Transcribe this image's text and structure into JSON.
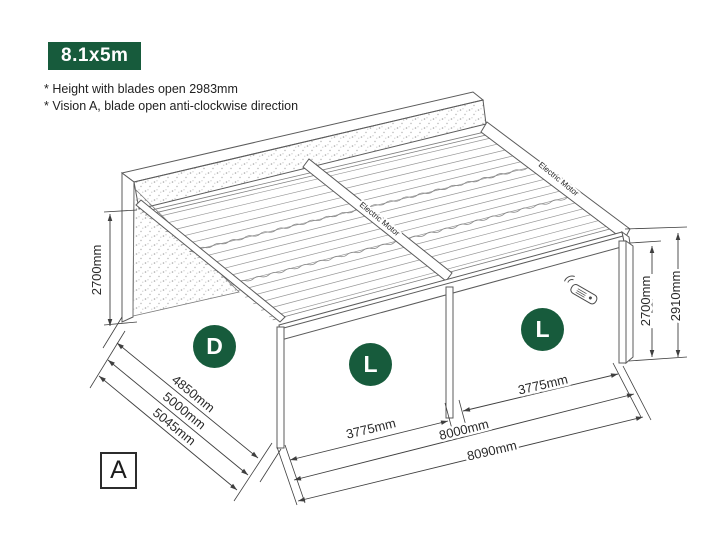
{
  "header": {
    "size_badge": "8.1x5m"
  },
  "notes": [
    "* Height with blades open 2983mm",
    "* Vision A, blade open anti-clockwise direction"
  ],
  "view_marker": "A",
  "roof": {
    "motor_label": "Electric Motor"
  },
  "badges": {
    "left_side": "D",
    "bay1": "L",
    "bay2": "L"
  },
  "dimensions": {
    "wall_height": "2700mm",
    "front_height_inner": "2700mm",
    "front_height_outer": "2910mm",
    "depth_inner": "4850mm",
    "depth_mid": "5000mm",
    "depth_outer": "5045mm",
    "bay1_width": "3775mm",
    "bay2_width": "3775mm",
    "length_inner": "8000mm",
    "length_outer": "8090mm"
  },
  "icons": {
    "remote": "remote-control-icon",
    "signal": "wireless-signal-icon"
  },
  "colors": {
    "accent_green": "#175b3c",
    "structure_line": "#5b5b5b",
    "louvre_line": "#979797",
    "dimension_line": "#3f3f3f",
    "text": "#2a2a2a"
  }
}
